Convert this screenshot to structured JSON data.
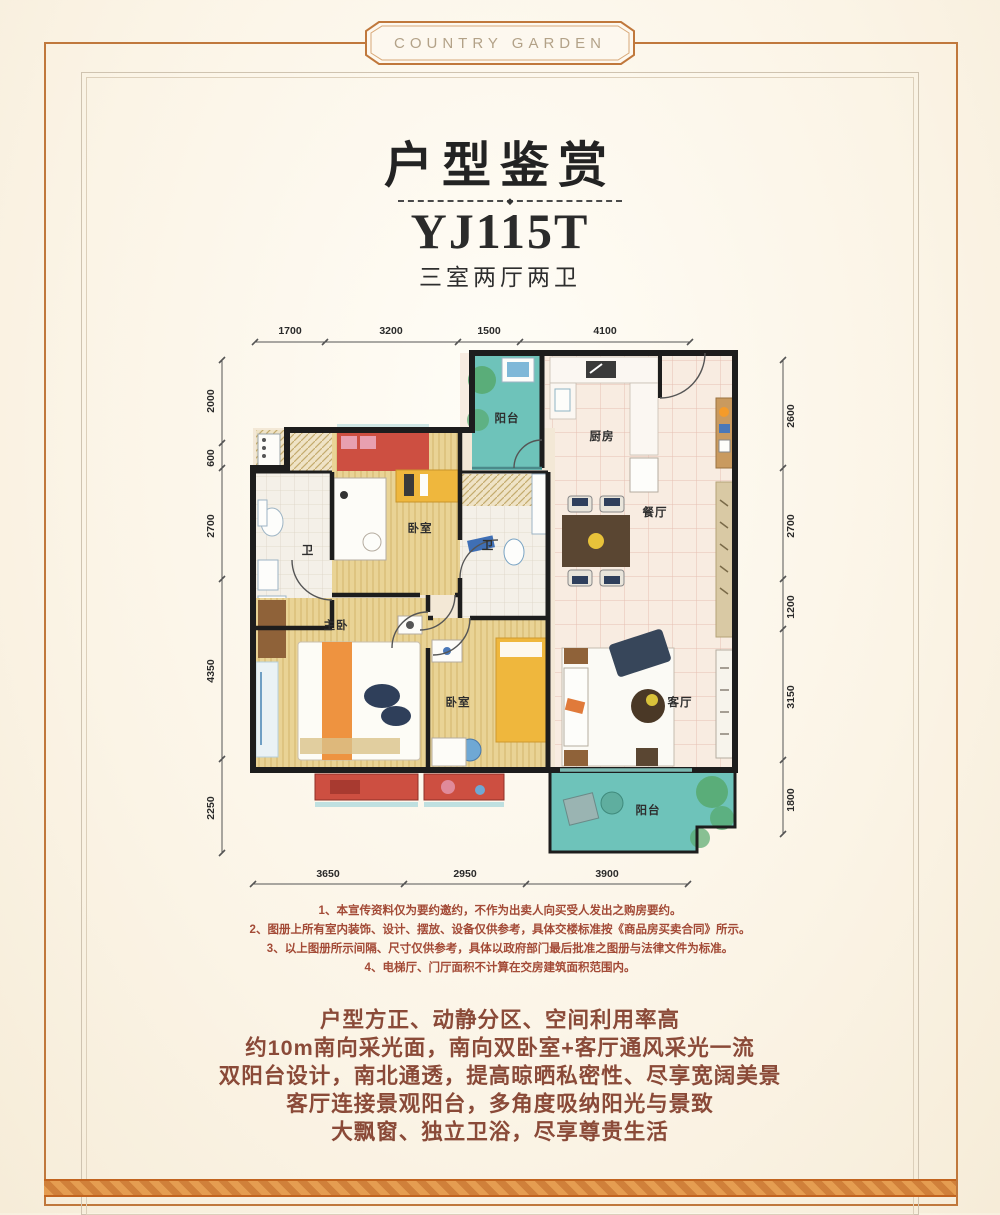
{
  "brand": {
    "logo": "COUNTRY GARDEN"
  },
  "header": {
    "title": "户型鉴赏",
    "divider_glyph": "◆",
    "unit_code": "YJ115T",
    "unit_type": "三室两厅两卫"
  },
  "plan": {
    "rooms": [
      {
        "id": "balcony-north",
        "label": "阳台"
      },
      {
        "id": "kitchen",
        "label": "厨房"
      },
      {
        "id": "dining",
        "label": "餐厅"
      },
      {
        "id": "bedroom-north",
        "label": "卧室"
      },
      {
        "id": "bath-1",
        "label": "卫"
      },
      {
        "id": "bath-2",
        "label": "卫"
      },
      {
        "id": "master-bedroom",
        "label": "主卧"
      },
      {
        "id": "bedroom-south",
        "label": "卧室"
      },
      {
        "id": "living",
        "label": "客厅"
      },
      {
        "id": "balcony-south",
        "label": "阳台"
      }
    ],
    "dims": {
      "top": [
        "1700",
        "3200",
        "1500",
        "4100"
      ],
      "bottom": [
        "3650",
        "2950",
        "3900"
      ],
      "left": [
        "2000",
        "600",
        "2700",
        "4350",
        "2250"
      ],
      "right": [
        "2600",
        "2700",
        "1200",
        "3150",
        "1800"
      ]
    }
  },
  "notes": [
    "1、本宣传资料仅为要约邀约，不作为出卖人向买受人发出之购房要约。",
    "2、图册上所有室内装饰、设计、摆放、设备仅供参考，具体交楼标准按《商品房买卖合同》所示。",
    "3、以上图册所示间隔、尺寸仅供参考，具体以政府部门最后批准之图册与法律文件为标准。",
    "4、电梯厅、门厅面积不计算在交房建筑面积范围内。"
  ],
  "highlights": [
    "户型方正、动静分区、空间利用率高",
    "约10m南向采光面，南向双卧室+客厅通风采光一流",
    "双阳台设计，南北通透，提高晾晒私密性、尽享宽阔美景",
    "客厅连接景观阳台，多角度吸纳阳光与景致",
    "大飘窗、独立卫浴，尽享尊贵生活"
  ],
  "colors": {
    "frame_gold": "#c0783c",
    "band_orange": "#d0803a",
    "note_red": "#a34a36",
    "highlight_brown": "#8a4a38",
    "wall_black": "#1d1d1d",
    "balcony_teal": "#6ec3ba",
    "wood_yellow": "#e9d395",
    "bay_red": "#cd4f41",
    "bed_orange": "#ee9340",
    "furniture_yellow": "#efb73d"
  }
}
